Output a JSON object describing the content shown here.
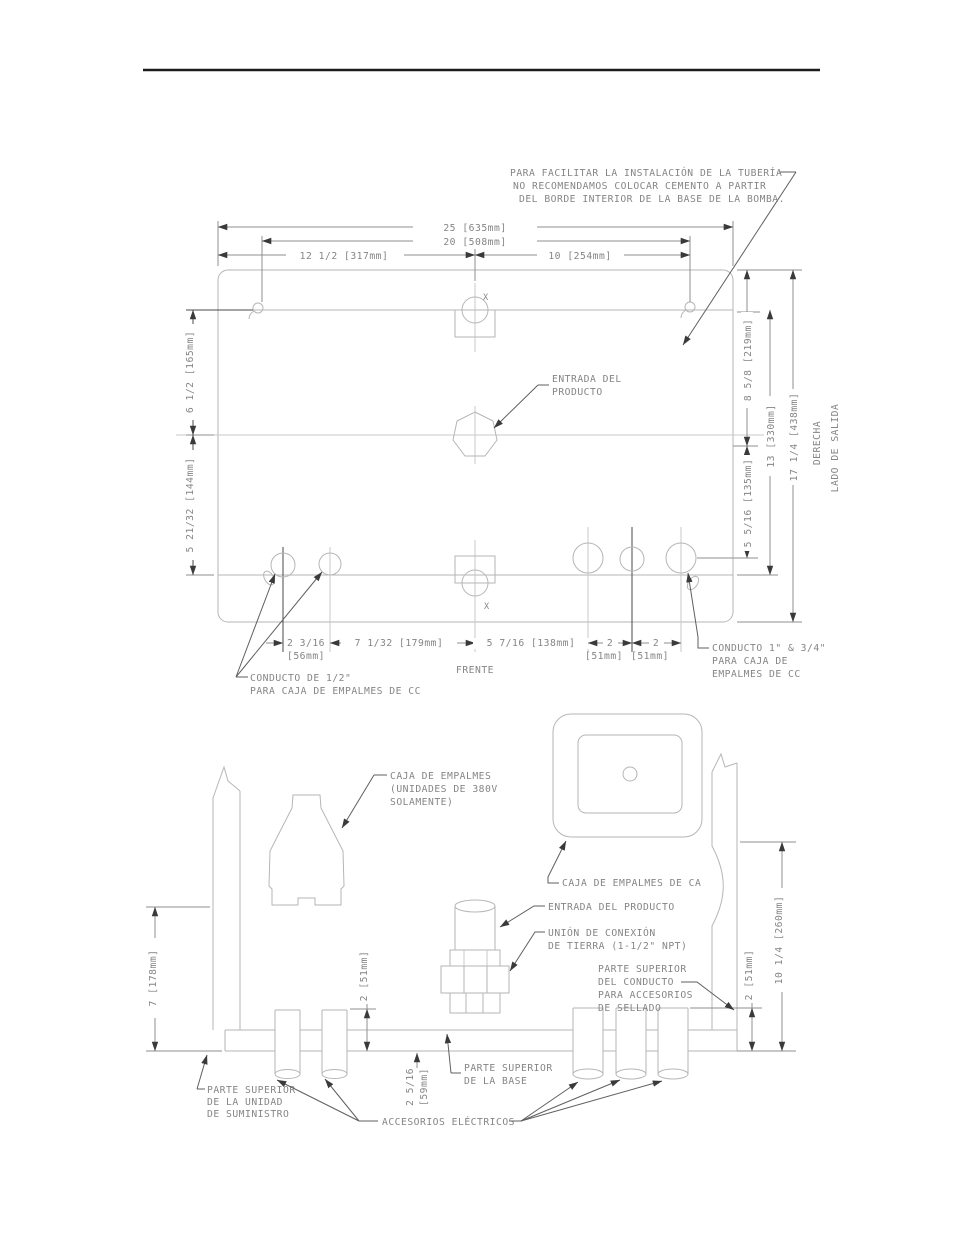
{
  "note": {
    "lines": [
      "PARA FACILITAR LA INSTALACIÓN DE LA TUBERÍA",
      "NO RECOMENDAMOS COLOCAR CEMENTO A PARTIR",
      "DEL BORDE INTERIOR DE LA BASE DE LA BOMBA."
    ]
  },
  "top_view": {
    "x_marker": "X",
    "dim_25": "25 [635mm]",
    "dim_20": "20 [508mm]",
    "dim_12_5": "12 1/2 [317mm]",
    "dim_10": "10 [254mm]",
    "dim_6_5": "6 1/2 [165mm]",
    "dim_5_21_32": "5 21/32 [144mm]",
    "dim_8_5_8": "8 5/8 [219mm]",
    "dim_5_5_16": "5 5/16 [135mm]",
    "dim_13": "13 [330mm]",
    "dim_17_1_4": "17 1/4 [438mm]",
    "derecha": "DERECHA",
    "lado_de_salida": "LADO DE SALIDA",
    "dim_2_3_16": "2 3/16",
    "dim_2_3_16_mm": "[56mm]",
    "dim_7_1_32": "7 1/32 [179mm]",
    "dim_5_7_16": "5 7/16 [138mm]",
    "dim_2_a": "2",
    "dim_2_a_mm": "[51mm]",
    "dim_2_b": "2",
    "dim_2_b_mm": "[51mm]",
    "frente": "FRENTE",
    "entrada_producto": [
      "ENTRADA DEL",
      "PRODUCTO"
    ],
    "conducto_half": [
      "CONDUCTO DE 1/2\"",
      "PARA CAJA DE EMPALMES DE CC"
    ],
    "conducto_1_34": [
      "CONDUCTO 1\" & 3/4\"",
      "PARA CAJA DE",
      "EMPALMES DE CC"
    ]
  },
  "side_view": {
    "caja_380": [
      "CAJA DE EMPALMES",
      "(UNIDADES DE 380V",
      "SOLAMENTE)"
    ],
    "caja_ca": "CAJA DE EMPALMES DE CA",
    "entrada_producto": "ENTRADA DEL PRODUCTO",
    "union_tierra": [
      "UNIÓN DE CONEXIÓN",
      "DE TIERRA (1-1/2\" NPT)"
    ],
    "parte_conducto": [
      "PARTE SUPERIOR",
      "DEL CONDUCTO",
      "PARA ACCESORIOS",
      "DE SELLADO"
    ],
    "parte_unidad": [
      "PARTE SUPERIOR",
      "DE LA UNIDAD",
      "DE SUMINISTRO"
    ],
    "parte_base": [
      "PARTE SUPERIOR",
      "DE LA BASE"
    ],
    "accesorios": "ACCESORIOS ELÉCTRICOS",
    "dim_7": "7 [178mm]",
    "dim_2_mid": "2 [51mm]",
    "dim_2_right": "2 [51mm]",
    "dim_10_1_4": "10 1/4 [260mm]",
    "dim_2_5_16": "2 5/16",
    "dim_2_5_16_mm": "[59mm]"
  }
}
